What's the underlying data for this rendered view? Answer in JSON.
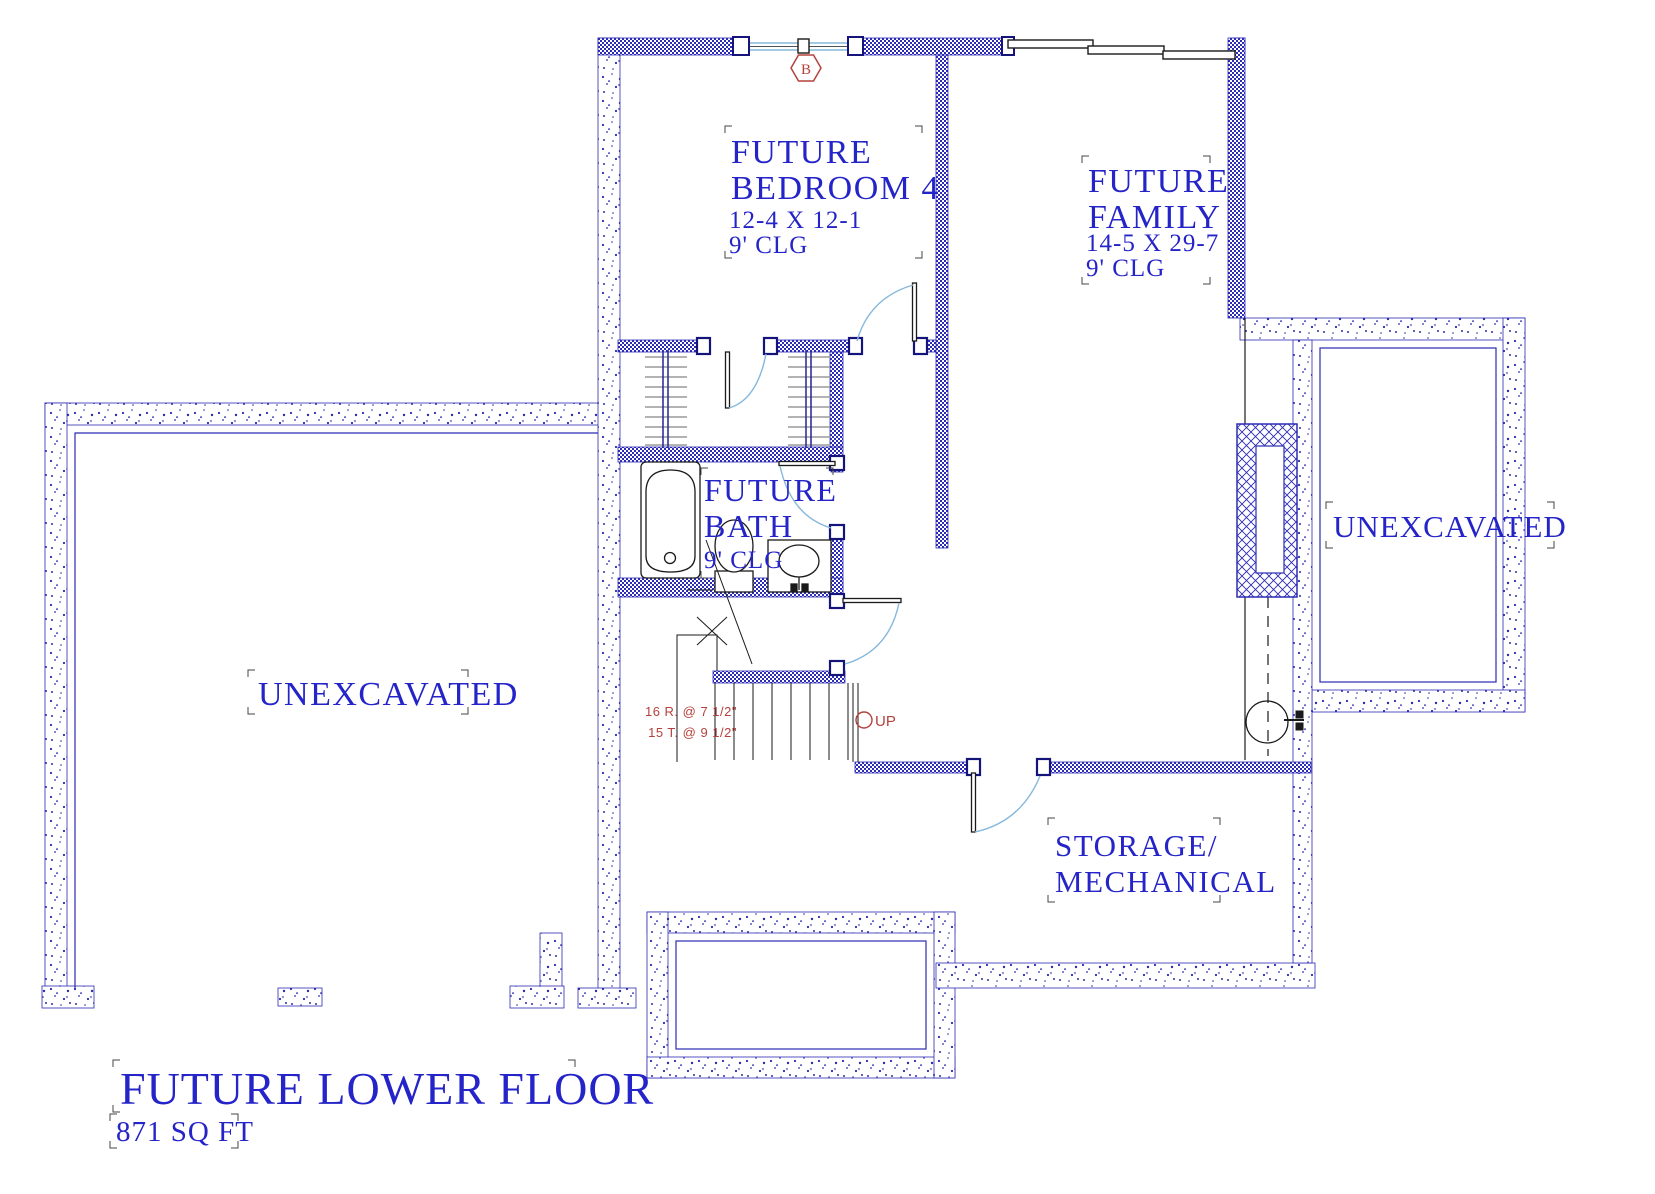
{
  "drawing": {
    "title": {
      "line1": "FUTURE LOWER FLOOR",
      "line2": "871 SQ FT"
    },
    "rooms": {
      "bedroom4": {
        "line1": "FUTURE",
        "line2": "BEDROOM 4",
        "dims": "12-4 X 12-1",
        "ceiling": "9' CLG"
      },
      "family": {
        "line1": "FUTURE",
        "line2": "FAMILY",
        "dims": "14-5 X 29-7",
        "ceiling": "9' CLG"
      },
      "bath": {
        "line1": "FUTURE",
        "line2": "BATH",
        "ceiling": "9' CLG"
      },
      "storage": {
        "line1": "STORAGE/",
        "line2": "MECHANICAL"
      },
      "unexcavated_left": {
        "label": "UNEXCAVATED"
      },
      "unexcavated_right": {
        "label": "UNEXCAVATED"
      }
    },
    "stairs": {
      "riser_note": "16 R. @ 7 1/2\"",
      "tread_note": "15 T. @ 9 1/2\"",
      "direction": "UP"
    },
    "window_tag": {
      "label": "B"
    },
    "colors": {
      "wall_blue": "#2b2bb5",
      "text_blue": "#2424c8",
      "annotation_red": "#b5413b",
      "door_arc_blue": "#85b8dc",
      "shelf_gray": "#9a9a9a",
      "fixture_black": "#1a1a1a"
    }
  }
}
